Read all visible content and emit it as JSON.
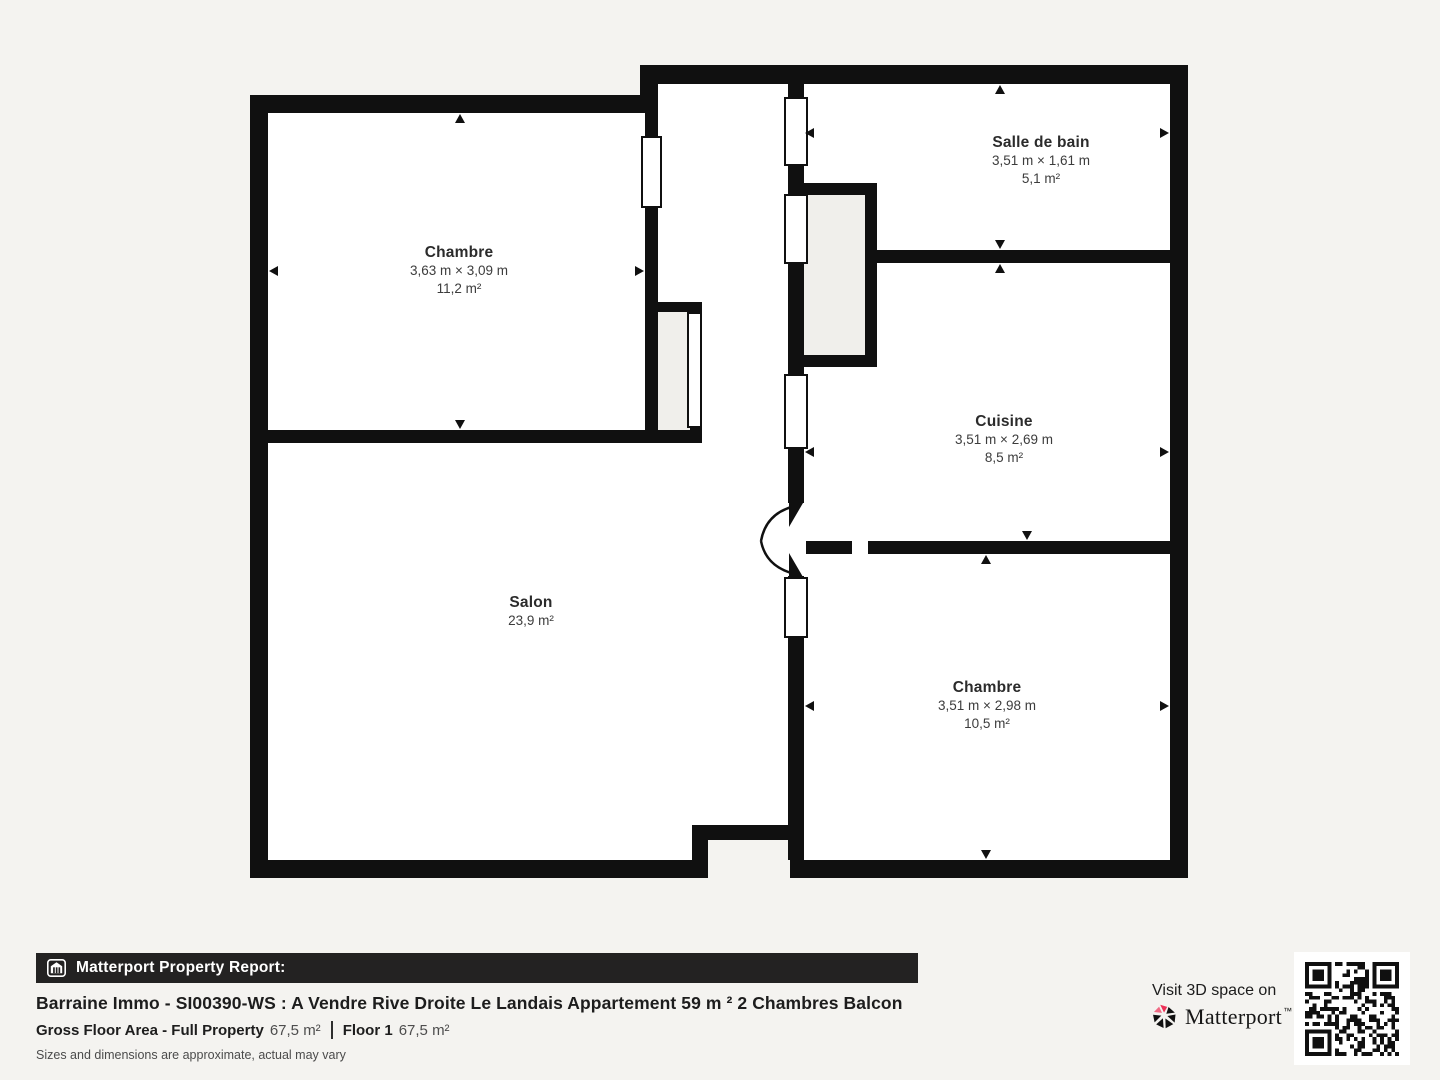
{
  "page": {
    "background": "#f4f3f0",
    "wall_color": "#101010",
    "closet_fill": "#f0efeb",
    "brand_red": "#ee3157"
  },
  "floor_plan": {
    "rooms": [
      {
        "id": "chambre-1",
        "name": "Chambre",
        "dimensions": "3,63 m × 3,09 m",
        "area": "11,2 m²"
      },
      {
        "id": "salle-de-bain",
        "name": "Salle de bain",
        "dimensions": "3,51 m × 1,61 m",
        "area": "5,1 m²"
      },
      {
        "id": "cuisine",
        "name": "Cuisine",
        "dimensions": "3,51 m × 2,69 m",
        "area": "8,5 m²"
      },
      {
        "id": "salon",
        "name": "Salon",
        "dimensions": "",
        "area": "23,9 m²"
      },
      {
        "id": "chambre-2",
        "name": "Chambre",
        "dimensions": "3,51 m × 2,98 m",
        "area": "10,5 m²"
      }
    ]
  },
  "report": {
    "bar_label": "Matterport Property Report:",
    "title": "Barraine Immo - SI00390-WS : A Vendre Rive Droite Le Landais Appartement 59 m ² 2 Chambres Balcon",
    "gross_floor_label": "Gross Floor Area - Full Property",
    "gross_floor_value": "67,5 m²",
    "floor_label": "Floor 1",
    "floor_value": "67,5 m²",
    "disclaimer": "Sizes and dimensions are approximate, actual may vary"
  },
  "cta": {
    "visit_text": "Visit 3D space on",
    "brand": "Matterport",
    "brand_mark": "™"
  }
}
